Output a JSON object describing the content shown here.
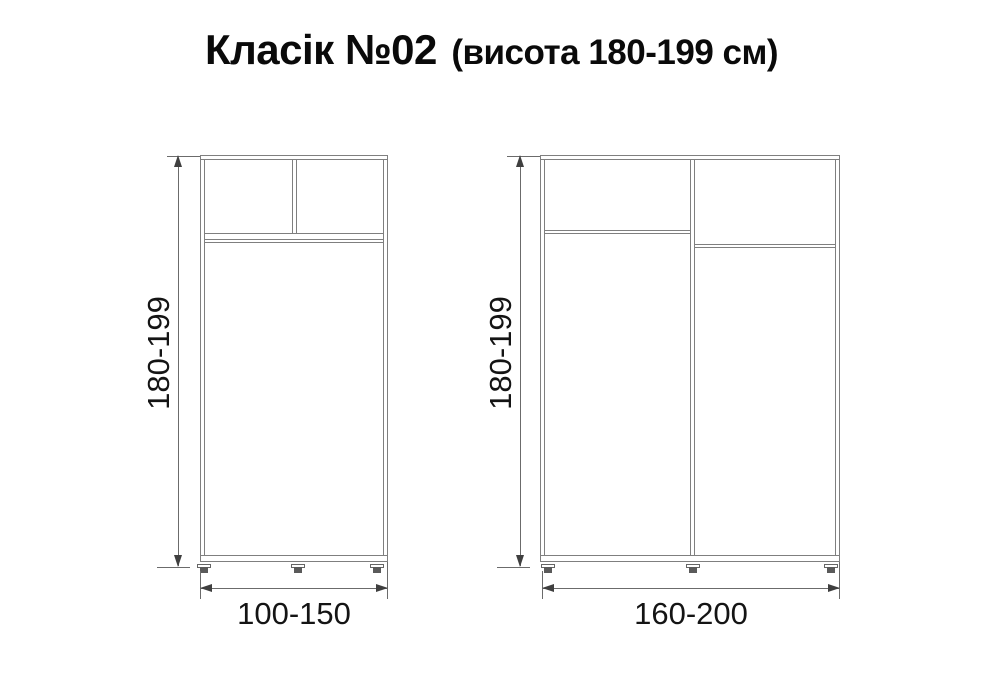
{
  "title": {
    "main": "Класік №02",
    "sub": "(висота 180-199 см)"
  },
  "diagrams": [
    {
      "name": "wardrobe-small",
      "description": "two-door wardrobe with split upper shelf compartment",
      "height_label": "180-199",
      "width_label": "100-150"
    },
    {
      "name": "wardrobe-large",
      "description": "two-section wardrobe with offset upper shelves",
      "height_label": "180-199",
      "width_label": "160-200"
    }
  ],
  "units": "см",
  "colors": {
    "furniture_line": "#7f7f7f",
    "dimension_line": "#6b6b6b",
    "arrow": "#3f3f3f",
    "text": "#141414",
    "background": "#ffffff"
  }
}
